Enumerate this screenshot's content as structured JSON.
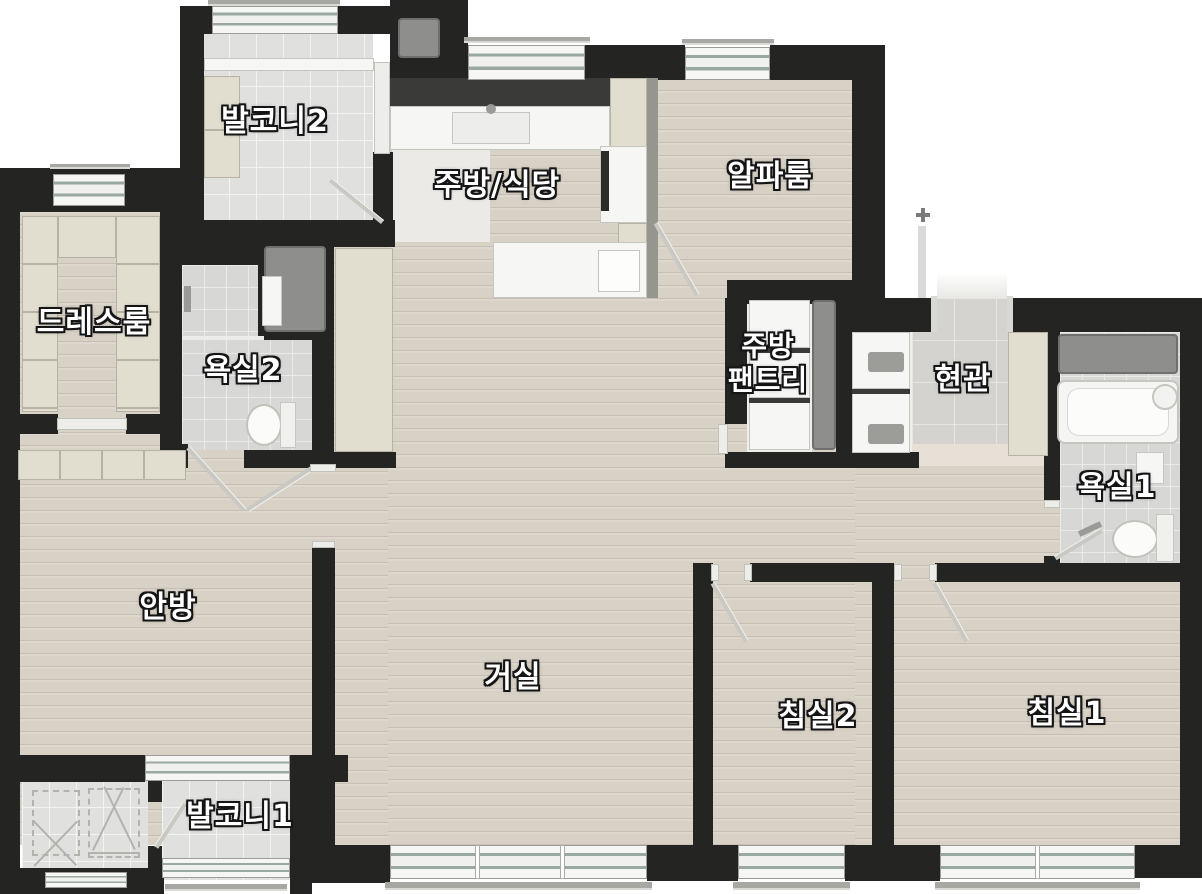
{
  "plan_title": "apartment-floor-plan",
  "rooms": {
    "balcony2": {
      "label": "발코니2"
    },
    "kitchen": {
      "label": "주방/식당"
    },
    "alpha": {
      "label": "알파룸"
    },
    "dress": {
      "label": "드레스룸"
    },
    "bath2": {
      "label": "욕실2"
    },
    "pantry": {
      "label_line1": "주방",
      "label_line2": "팬트리"
    },
    "entry": {
      "label": "현관"
    },
    "bath1": {
      "label": "욕실1"
    },
    "master": {
      "label": "안방"
    },
    "living": {
      "label": "거실"
    },
    "bed2": {
      "label": "침실2"
    },
    "bed1": {
      "label": "침실1"
    },
    "balcony1": {
      "label": "발코니1"
    }
  },
  "fixtures": [
    "toilet-icon",
    "bathtub-icon",
    "sink-icon",
    "kitchen-sink-icon",
    "island-counter",
    "wardrobe",
    "pantry-shelves",
    "shoe-cabinet",
    "duct-shaft",
    "window",
    "door-swing",
    "railing",
    "ac-unit-marks"
  ],
  "colors": {
    "wall": "#242423",
    "wood_floor": "#d8d1c6",
    "balcony_tile": "#e0e0de",
    "bath_tile": "#d7d7d5",
    "entry_tile": "#d5d3cf",
    "cabinet_beige": "#e2decf",
    "duct_gray": "#8e8e8c",
    "counter_dark": "#3a3a38",
    "fixture_white": "#f6f6f4",
    "label_text": "#ffffff",
    "label_outline": "#151515"
  }
}
